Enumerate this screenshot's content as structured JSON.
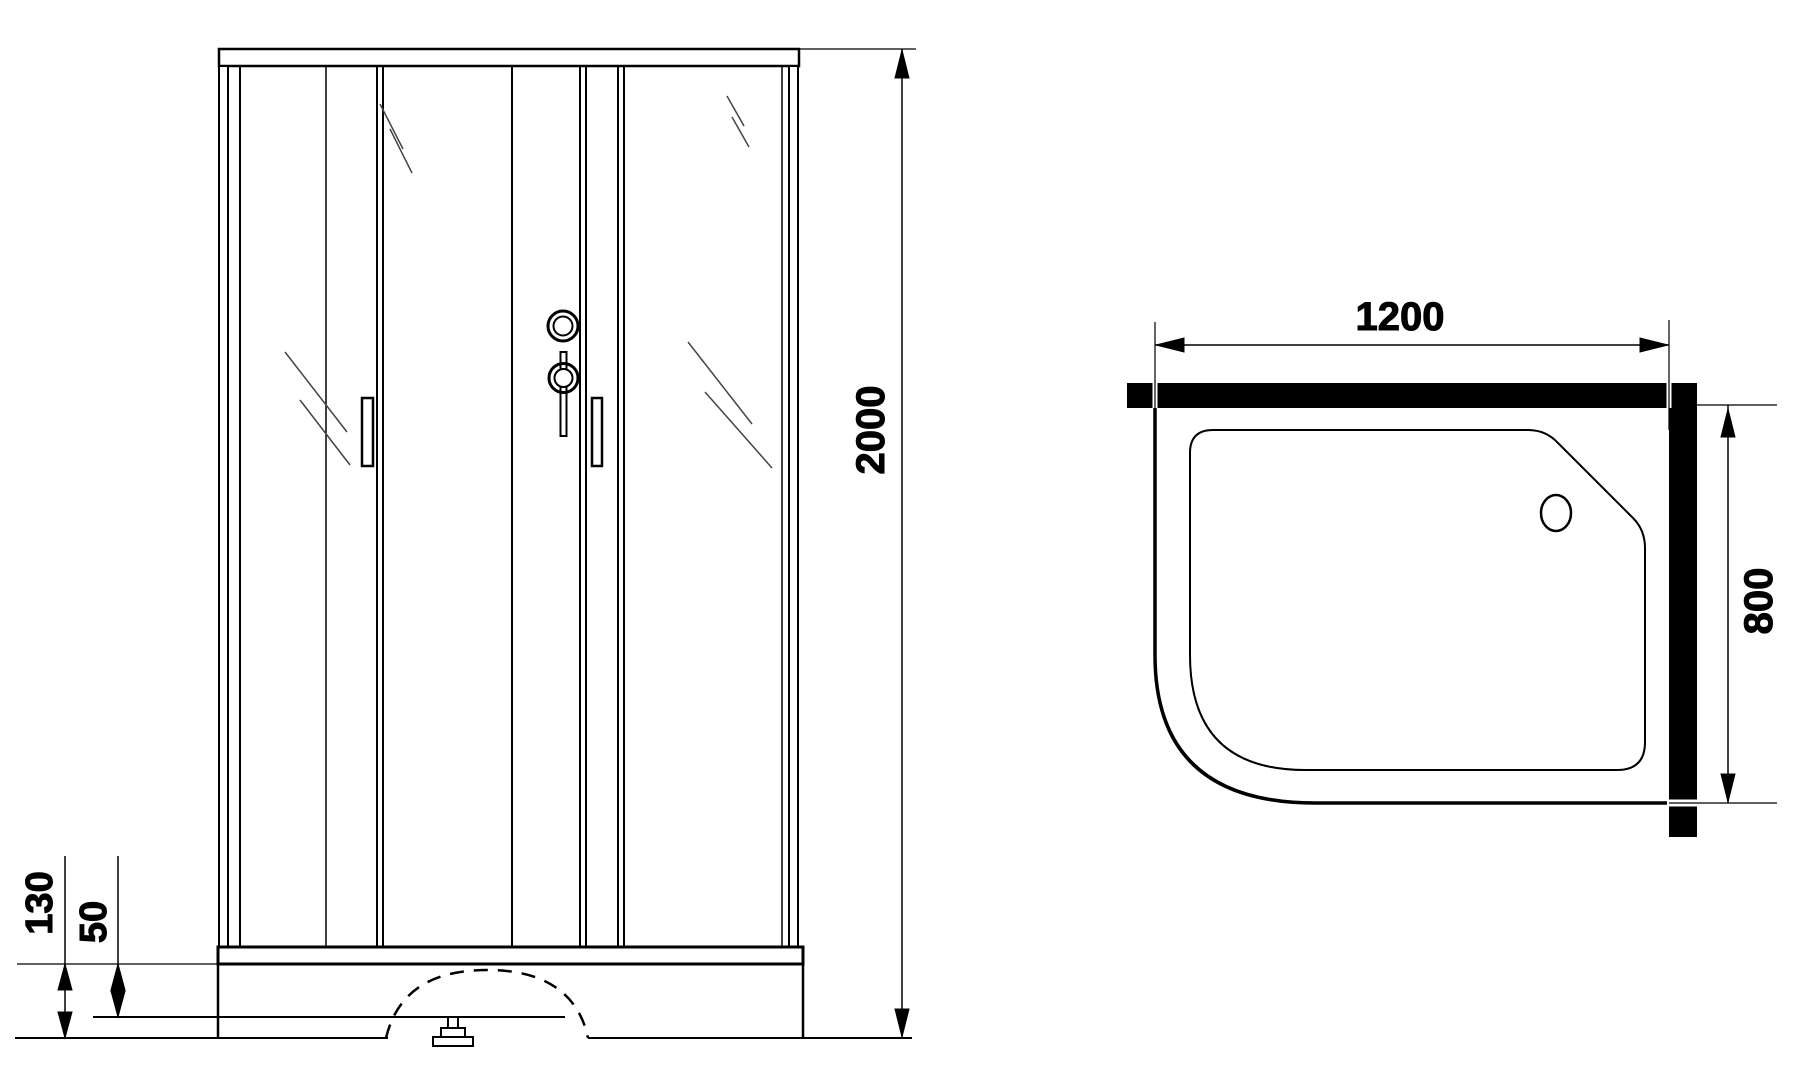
{
  "drawing": {
    "type": "shower-cabin-technical-drawing",
    "front_view": {
      "height_label": "2000",
      "tray_height_label": "130",
      "tray_depth_label": "50"
    },
    "plan_view": {
      "width_label": "1200",
      "depth_label": "800"
    },
    "style": {
      "line_color": "#000000",
      "bg_color": "#ffffff"
    }
  }
}
